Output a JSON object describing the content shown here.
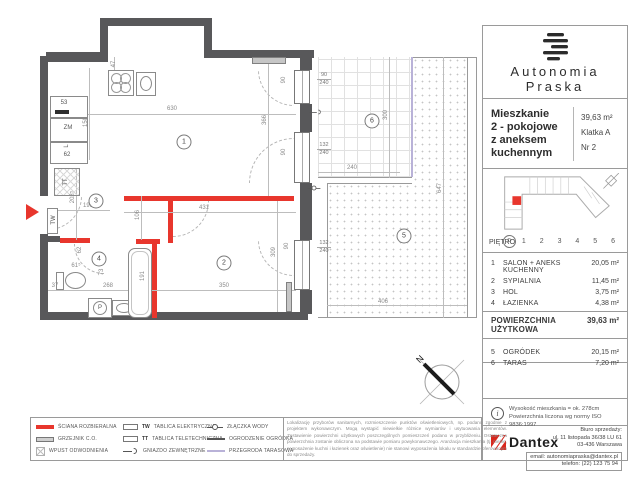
{
  "colors": {
    "wall": "#58585a",
    "removable_wall": "#e8362d",
    "terrace_divider": "#b9b2d8",
    "dim_text": "#8a8a8a"
  },
  "logo": {
    "name_line1": "Autonomia",
    "name_line2": "Praska"
  },
  "apartment": {
    "title_lines": [
      "Mieszkanie",
      "2 - pokojowe",
      "z aneksem",
      "kuchennym"
    ],
    "area": "39,63 m²",
    "staircase": "Klatka A",
    "number": "Nr 2"
  },
  "floor_selector": {
    "label": "PIĘTRO",
    "current": "P",
    "floors": [
      "1",
      "2",
      "3",
      "4",
      "5",
      "6"
    ]
  },
  "rooms_table": {
    "rows": [
      {
        "no": "1",
        "name": "SALON + ANEKS KUCHENNY",
        "area": "20,05 m²"
      },
      {
        "no": "2",
        "name": "SYPIALNIA",
        "area": "11,45 m²"
      },
      {
        "no": "3",
        "name": "HOL",
        "area": "3,75 m²"
      },
      {
        "no": "4",
        "name": "ŁAZIENKA",
        "area": "4,38 m²"
      }
    ],
    "total_label": "POWIERZCHNIA UŻYTKOWA",
    "total_value": "39,63 m²",
    "outdoor_rows": [
      {
        "no": "5",
        "name": "OGRÓDEK",
        "area": "20,15 m²"
      },
      {
        "no": "6",
        "name": "TARAS",
        "area": "7,20 m²"
      }
    ]
  },
  "note": {
    "line1": "Wysokość mieszkania = ok. 278cm",
    "line2": "Powierzchnia liczona wg normy ISO 9836:1997"
  },
  "developer": {
    "brand": "Dantex",
    "office_label": "Biuro sprzedaży:",
    "address_line1": "ul. 11 listopada 36/38 LU 61",
    "address_line2": "03-436 Warszawa",
    "email": "email: autonomiapraska@dantex.pl",
    "phone": "telefon: (22) 123 75 94"
  },
  "legend": {
    "columns": [
      [
        {
          "sym": "red-wall",
          "label": "ŚCIANA ROZBIERALNA"
        },
        {
          "sym": "radiator",
          "label": "GRZEJNIK C.O."
        },
        {
          "sym": "drain",
          "label": "WPUST ODWODNIENIA"
        }
      ],
      [
        {
          "sym": "panel",
          "tag": "TW",
          "label": "TABLICA ELEKTRYCZNA"
        },
        {
          "sym": "panel",
          "tag": "TT",
          "label": "TABLICA TELETECHNICZNA"
        },
        {
          "sym": "socket",
          "label": "GNIAZDO ZEWNĘTRZNE"
        }
      ],
      [
        {
          "sym": "water",
          "label": "ZŁĄCZKA WODY"
        },
        {
          "sym": "fence",
          "label": "OGRODZENIE OGRÓDKA"
        },
        {
          "sym": "terrace",
          "label": "PRZEGRODA TARASOWA"
        }
      ]
    ]
  },
  "disclaimer_lines": [
    "Lokalizację przyborów sanitarnych, rozmieszczenie punktów oświetleniowych, np. podano zgodnie z projektem wykonawczym.",
    "Mogą wystąpić niewielkie różnice wymiarów i usytuowania elementów.",
    "Zestawienie powierzchni użytkowych poszczególnych pomieszczeń podano w przybliżeniu.",
    "Ostateczna powierzchnia zostanie obliczona na podstawie pomiaru powykonawczego.",
    "Aranżacja mieszkania (tj. meble, wyposażenie kuchni i łazienek oraz oświetlenie) nie stanowi",
    "wyposażenia lokalu w standardzie oferowanym do sprzedaży."
  ],
  "plan": {
    "washer_label": "P",
    "compass_label": "N",
    "rooms": [
      {
        "n": "1",
        "x": 184,
        "y": 142
      },
      {
        "n": "2",
        "x": 224,
        "y": 263
      },
      {
        "n": "3",
        "x": 96,
        "y": 201
      },
      {
        "n": "4",
        "x": 99,
        "y": 259
      },
      {
        "n": "5",
        "x": 404,
        "y": 236
      },
      {
        "n": "6",
        "x": 372,
        "y": 121
      }
    ],
    "dimensions": [
      {
        "t": "630",
        "x": 172,
        "y": 109
      },
      {
        "t": "47",
        "x": 114,
        "y": 64,
        "rot": 1
      },
      {
        "t": "150",
        "x": 86,
        "y": 122,
        "rot": 1
      },
      {
        "t": "366",
        "x": 265,
        "y": 120,
        "rot": 1
      },
      {
        "t": "90",
        "x": 284,
        "y": 80,
        "rot": 1
      },
      {
        "t": "90",
        "x": 284,
        "y": 152,
        "rot": 1
      },
      {
        "t": "240",
        "x": 352,
        "y": 168
      },
      {
        "t": "300",
        "x": 386,
        "y": 115,
        "rot": 1
      },
      {
        "t": "647",
        "x": 440,
        "y": 188,
        "rot": 1
      },
      {
        "t": "431",
        "x": 204,
        "y": 208
      },
      {
        "t": "106",
        "x": 138,
        "y": 215,
        "rot": 1
      },
      {
        "t": "202⁵",
        "x": 73,
        "y": 197,
        "rot": 1
      },
      {
        "t": "191",
        "x": 88,
        "y": 206
      },
      {
        "t": "62",
        "x": 80,
        "y": 250,
        "rot": 1
      },
      {
        "t": "309",
        "x": 274,
        "y": 252,
        "rot": 1
      },
      {
        "t": "90",
        "x": 287,
        "y": 246,
        "rot": 1
      },
      {
        "t": "350",
        "x": 224,
        "y": 286
      },
      {
        "t": "268",
        "x": 108,
        "y": 286
      },
      {
        "t": "61⁵",
        "x": 76,
        "y": 266
      },
      {
        "t": "73",
        "x": 102,
        "y": 272,
        "rot": 1
      },
      {
        "t": "37",
        "x": 55,
        "y": 286
      },
      {
        "t": "191",
        "x": 143,
        "y": 276,
        "rot": 1
      },
      {
        "t": "406",
        "x": 383,
        "y": 302
      }
    ],
    "windows": [
      {
        "top": "90",
        "bottom": "240",
        "x": 314,
        "y": 72
      },
      {
        "top": "132",
        "bottom": "240",
        "x": 314,
        "y": 142
      },
      {
        "top": "132",
        "bottom": "240",
        "x": 314,
        "y": 240
      }
    ],
    "fixtures": [
      {
        "t": "53",
        "x": 64,
        "y": 103
      },
      {
        "t": "ZM",
        "x": 68,
        "y": 128
      },
      {
        "t": "L",
        "x": 67,
        "y": 146,
        "rot": 1
      },
      {
        "t": "62",
        "x": 67,
        "y": 155
      },
      {
        "t": "TT",
        "x": 66,
        "y": 182,
        "rot": 1
      },
      {
        "t": "TW",
        "x": 54,
        "y": 220,
        "rot": 1
      }
    ]
  }
}
